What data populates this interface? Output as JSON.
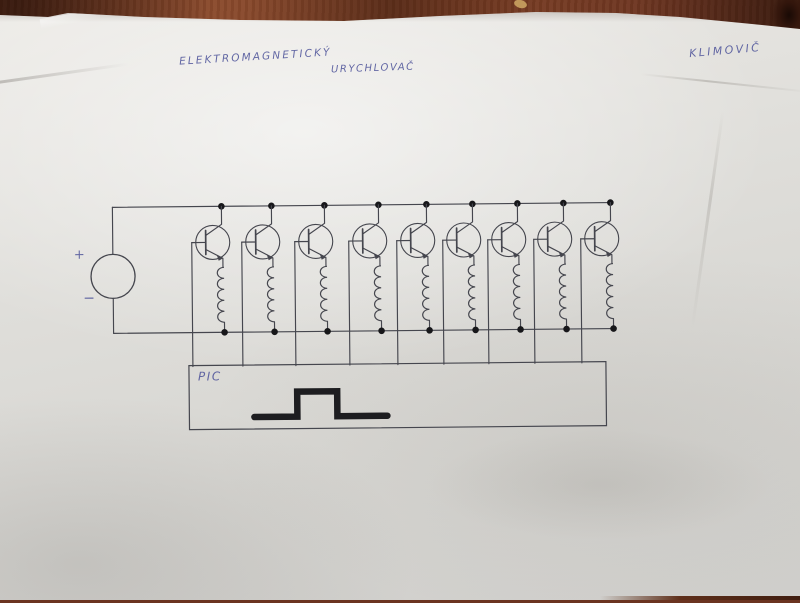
{
  "photo": {
    "table_color": "#7b3e24",
    "paper_color": "#dfdeda",
    "wood_knot_color": "#33160c",
    "speck_color": "#c59d5e"
  },
  "handwriting": {
    "ink_color": "#575c9e",
    "title_line1": "ELEKTROMAGNETICKÝ",
    "title_line2": "URYCHLOVAČ",
    "signature": "KLIMOVIČ"
  },
  "circuit": {
    "ink_color": "#45464e",
    "dot_color": "#17171a",
    "pulse_color": "#1d1d20",
    "top_rail_y": 205,
    "bottom_rail_y": 331,
    "rail_x_start": 113,
    "rail_x_end": 611,
    "stage_count": 9,
    "stage_x": [
      222,
      272,
      325,
      379,
      427,
      473,
      518,
      564,
      611
    ],
    "source": {
      "cx": 113,
      "cy": 274,
      "r": 22,
      "plus_label": "+",
      "minus_label": "−"
    },
    "controller": {
      "label": "PIC",
      "x": 188,
      "y": 364,
      "width": 417,
      "height": 64
    },
    "pulse_waveform": [
      [
        253,
        416
      ],
      [
        296,
        416
      ],
      [
        296,
        391
      ],
      [
        336,
        391
      ],
      [
        336,
        416
      ],
      [
        386,
        416
      ]
    ]
  }
}
